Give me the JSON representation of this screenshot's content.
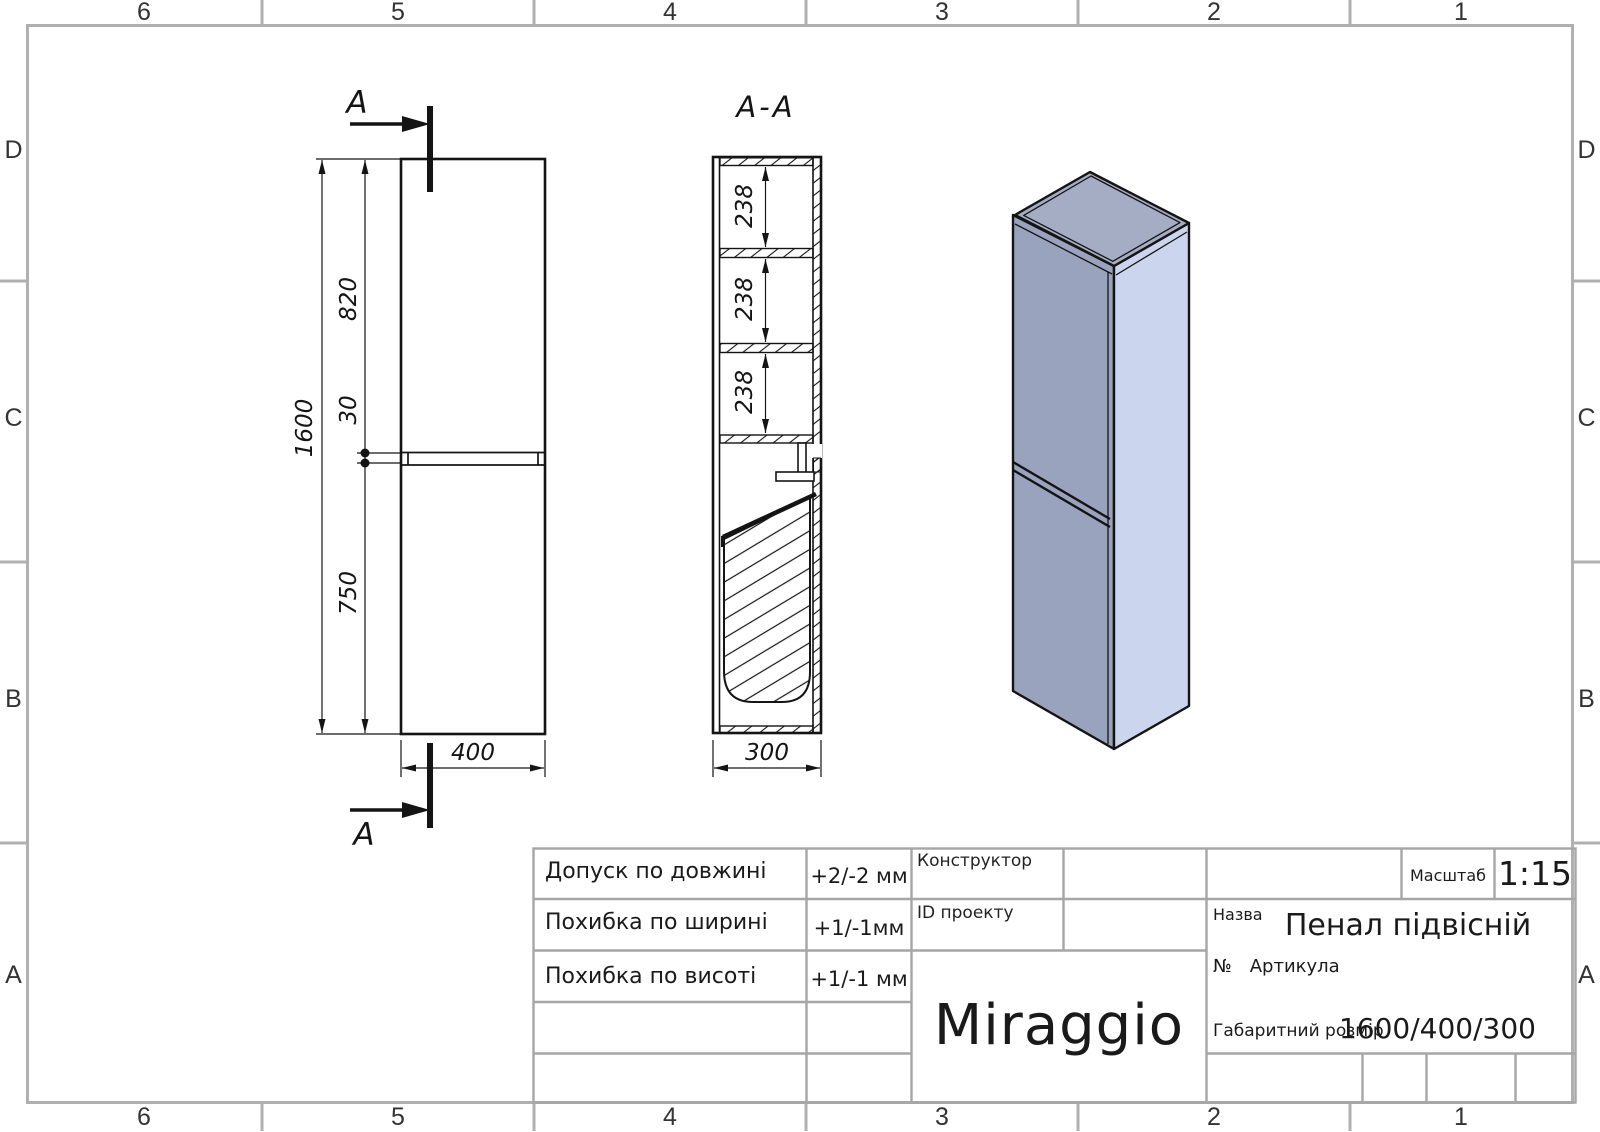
{
  "sheet": {
    "cols": [
      "6",
      "5",
      "4",
      "3",
      "2",
      "1"
    ],
    "rows": [
      "D",
      "C",
      "B",
      "A"
    ]
  },
  "drawing": {
    "section_title": "A-A",
    "cut_label": "A",
    "dims": {
      "overall_height": "1600",
      "upper_door_height": "820",
      "door_gap": "30",
      "lower_door_height": "750",
      "width": "400",
      "depth": "300",
      "shelf_spacing": "238"
    }
  },
  "title_block": {
    "tolerances": [
      {
        "label": "Допуск по довжині",
        "value": "+2/-2 мм"
      },
      {
        "label": "Похибка по ширині",
        "value": "+1/-1мм"
      },
      {
        "label": "Похибка по висоті",
        "value": "+1/-1 мм"
      }
    ],
    "constructor_label": "Конструктор",
    "project_id_label": "ID проекту",
    "brand": "Miraggio",
    "scale_label": "Масштаб",
    "scale_value": "1:15",
    "name_label": "Назва",
    "name_value": "Пенал підвісній",
    "article_prefix": "№",
    "article_label": "Артикула",
    "size_label": "Габаритний розмір",
    "size_value": "1600/400/300"
  },
  "colors": {
    "line_black": "#141414",
    "frame_gray": "#b0b0b0",
    "title_gray": "#a6a6a6",
    "iso_front": "#9aa3bd",
    "iso_side": "#ccd5ee",
    "iso_top": "#a5adc4"
  }
}
